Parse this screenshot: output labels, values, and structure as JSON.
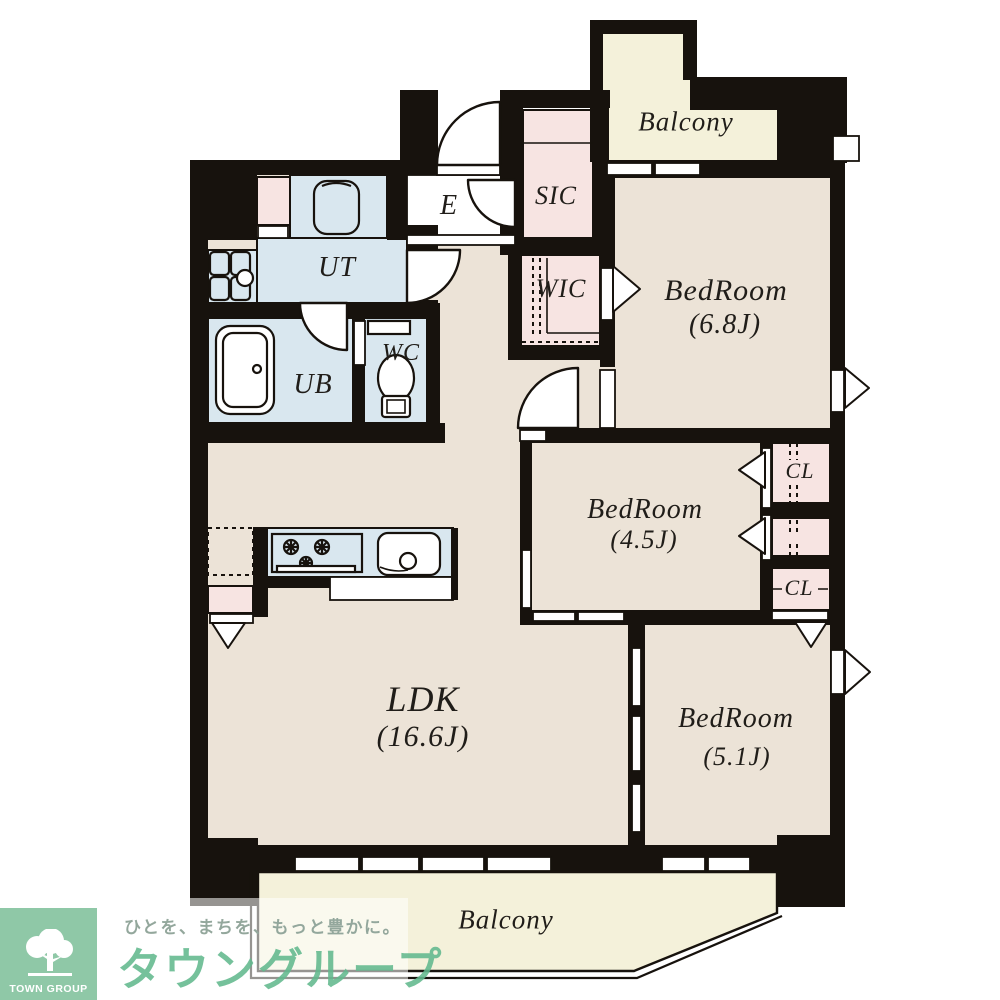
{
  "rooms": {
    "balcony_top": "Balcony",
    "bedroom1": {
      "name": "BedRoom",
      "size": "(6.8J)"
    },
    "bedroom2": {
      "name": "BedRoom",
      "size": "(4.5J)"
    },
    "bedroom3": {
      "name": "BedRoom",
      "size": "(5.1J)"
    },
    "ldk": {
      "name": "LDK",
      "size": "(16.6J)"
    },
    "wic": "WIC",
    "sic": "SIC",
    "entrance": "E",
    "ut": "UT",
    "ub": "UB",
    "wc": "WC",
    "cl1": "CL",
    "cl2": "CL",
    "balcony_bottom": "Balcony"
  },
  "branding": {
    "tagline": "ひとを、まちを、もっと豊かに。",
    "company": "タウングループ",
    "logo_text": "TOWN GROUP"
  },
  "colors": {
    "wall": "#17120d",
    "beige": "#ece3d7",
    "cream": "#f4f1da",
    "pink": "#f7e4e2",
    "blue": "#d9e7ef",
    "green_bg": "#8fc8a7",
    "green_text": "#62b98e",
    "tagline": "#93a79c"
  }
}
